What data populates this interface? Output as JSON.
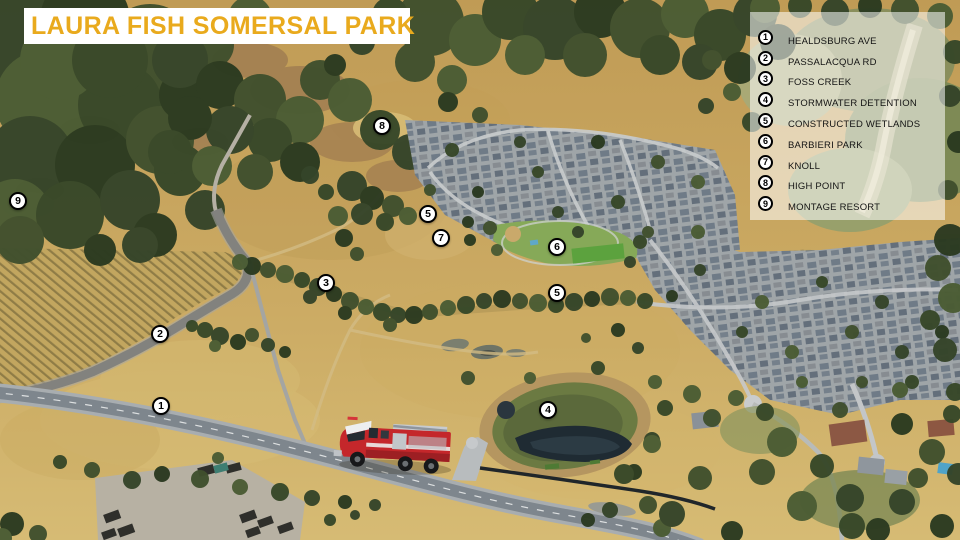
{
  "title": "LAURA FISH SOMERSAL PARK",
  "colors": {
    "title_text": "#E9AA1D",
    "banner_bg": "#FFFFFF",
    "legend_bg": "rgba(255,255,255,0.55)",
    "marker_bg": "#FFFFFF",
    "marker_border": "#000000"
  },
  "legend": {
    "items": [
      {
        "num": "1",
        "label": "HEALDSBURG AVE"
      },
      {
        "num": "2",
        "label": "PASSALACQUA RD"
      },
      {
        "num": "3",
        "label": "FOSS CREEK"
      },
      {
        "num": "4",
        "label": "STORMWATER DETENTION"
      },
      {
        "num": "5",
        "label": "CONSTRUCTED WETLANDS"
      },
      {
        "num": "6",
        "label": "BARBIERI PARK"
      },
      {
        "num": "7",
        "label": "KNOLL"
      },
      {
        "num": "8",
        "label": "HIGH POINT"
      },
      {
        "num": "9",
        "label": "MONTAGE RESORT"
      }
    ]
  },
  "markers": [
    {
      "num": "8",
      "x": 382,
      "y": 126
    },
    {
      "num": "9",
      "x": 18,
      "y": 201
    },
    {
      "num": "5",
      "x": 428,
      "y": 214
    },
    {
      "num": "7",
      "x": 441,
      "y": 238
    },
    {
      "num": "6",
      "x": 557,
      "y": 247
    },
    {
      "num": "3",
      "x": 326,
      "y": 283
    },
    {
      "num": "5",
      "x": 557,
      "y": 293
    },
    {
      "num": "2",
      "x": 160,
      "y": 334
    },
    {
      "num": "1",
      "x": 161,
      "y": 406
    },
    {
      "num": "4",
      "x": 548,
      "y": 410
    }
  ]
}
